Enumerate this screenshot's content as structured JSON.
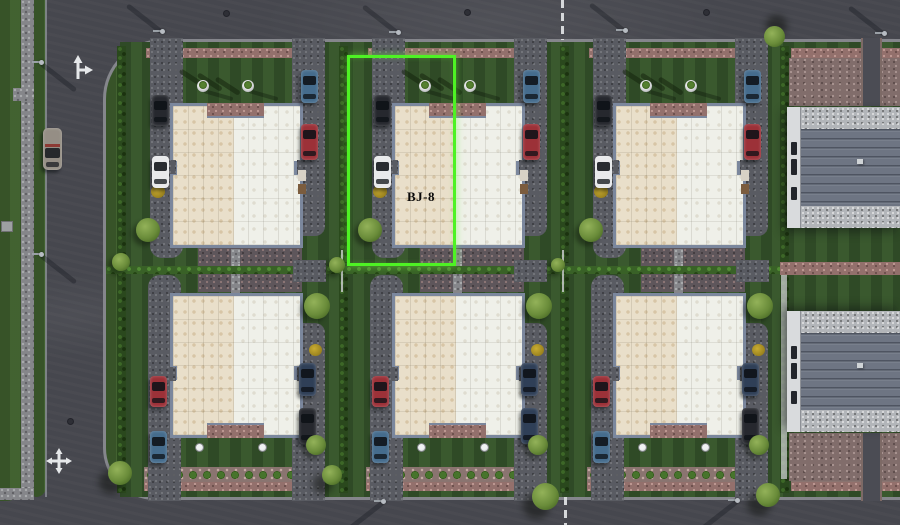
{
  "scene": {
    "description": "aerial-masterplan-render",
    "selection": {
      "label": "BJ-8",
      "color": "#4ef224",
      "x": 347,
      "y": 55,
      "width": 109,
      "height": 211,
      "label_x": 399,
      "label_y": 189,
      "label_w": 44
    },
    "colors": {
      "asphalt": "#46474e",
      "grass": "#3c5b2c",
      "lawn": "#34522a",
      "hedge": "#2a481d",
      "roof_left_unit": "#e9dfca",
      "roof_right_unit": "#eff0e9",
      "house_wall": "#7b879d",
      "warehouse_roof": "#6e7583",
      "warehouse_strip": "#d9dbdd",
      "selection": "#4ef224",
      "curb": "#85868c",
      "pink_gravel": "#93706c"
    },
    "car_colors": {
      "dark": "#26282e",
      "white": "#e8e9eb",
      "blue": "#456c8d",
      "red": "#9c3138",
      "steel": "#2f3f57",
      "road_car": "#958e85"
    },
    "rows": {
      "top_y": 42,
      "top_h": 225,
      "bottom_y": 267,
      "bottom_h": 230
    },
    "plots": [
      {
        "id": "plot-top-1",
        "type": "house",
        "row": "top",
        "x": 120,
        "cars_left": [
          "dark",
          "white"
        ],
        "cars_right": [
          "blue",
          "red"
        ]
      },
      {
        "id": "plot-top-2",
        "type": "house",
        "row": "top",
        "x": 342,
        "selected": true,
        "cars_left": [
          "dark",
          "white"
        ],
        "cars_right": [
          "blue",
          "red"
        ]
      },
      {
        "id": "plot-top-3",
        "type": "house",
        "row": "top",
        "x": 563,
        "cars_left": [
          "dark",
          "white"
        ],
        "cars_right": [
          "blue",
          "red"
        ]
      },
      {
        "id": "plot-top-4",
        "type": "warehouse",
        "row": "top",
        "x": 783
      },
      {
        "id": "plot-bottom-1",
        "type": "house",
        "row": "bottom",
        "x": 120,
        "cars_left": [
          "red",
          "blue"
        ],
        "cars_right": [
          "steel",
          "dark"
        ]
      },
      {
        "id": "plot-bottom-2",
        "type": "house",
        "row": "bottom",
        "x": 342,
        "cars_left": [
          "red",
          "blue"
        ],
        "cars_right": [
          "steel",
          "steel"
        ]
      },
      {
        "id": "plot-bottom-3",
        "type": "house",
        "row": "bottom",
        "x": 563,
        "cars_left": [
          "red",
          "blue"
        ],
        "cars_right": [
          "steel",
          "dark"
        ]
      },
      {
        "id": "plot-bottom-4",
        "type": "warehouse",
        "row": "bottom",
        "x": 783
      }
    ],
    "road_markings": [
      {
        "type": "straight-right-arrow",
        "x": 70,
        "y": 55
      },
      {
        "type": "cross-arrow",
        "x": 46,
        "y": 448
      }
    ],
    "manholes": [
      [
        223,
        10
      ],
      [
        464,
        9
      ],
      [
        703,
        9
      ],
      [
        67,
        418
      ]
    ],
    "lane_lines": [
      {
        "x": 561,
        "y": 0,
        "h": 40
      },
      {
        "x": 564,
        "y": 497,
        "h": 28
      }
    ],
    "street_lamps": [
      {
        "x": 160,
        "y": 29,
        "dir": "up-left"
      },
      {
        "x": 396,
        "y": 30,
        "dir": "up-left"
      },
      {
        "x": 623,
        "y": 28,
        "dir": "up-left"
      },
      {
        "x": 882,
        "y": 31,
        "dir": "up-left"
      },
      {
        "x": 39,
        "y": 60,
        "dir": "down-right"
      },
      {
        "x": 39,
        "y": 252,
        "dir": "down-right"
      },
      {
        "x": 381,
        "y": 499,
        "dir": "down-left"
      },
      {
        "x": 735,
        "y": 498,
        "dir": "down-left"
      }
    ],
    "road_vehicles": [
      {
        "color": "road_car",
        "x": 43,
        "y": 128
      }
    ],
    "trees": [
      {
        "x": 764,
        "y": 26,
        "d": 21,
        "shadow": "up"
      },
      {
        "x": 108,
        "y": 461,
        "d": 24,
        "shadow": "down"
      },
      {
        "x": 322,
        "y": 465,
        "d": 20,
        "shadow": "down"
      },
      {
        "x": 532,
        "y": 483,
        "d": 27,
        "shadow": "down"
      },
      {
        "x": 756,
        "y": 483,
        "d": 24,
        "shadow": "down"
      },
      {
        "x": 112,
        "y": 253,
        "d": 18,
        "shadow": "none"
      },
      {
        "x": 329,
        "y": 257,
        "d": 16,
        "shadow": "none"
      },
      {
        "x": 551,
        "y": 258,
        "d": 14,
        "shadow": "none"
      }
    ]
  }
}
